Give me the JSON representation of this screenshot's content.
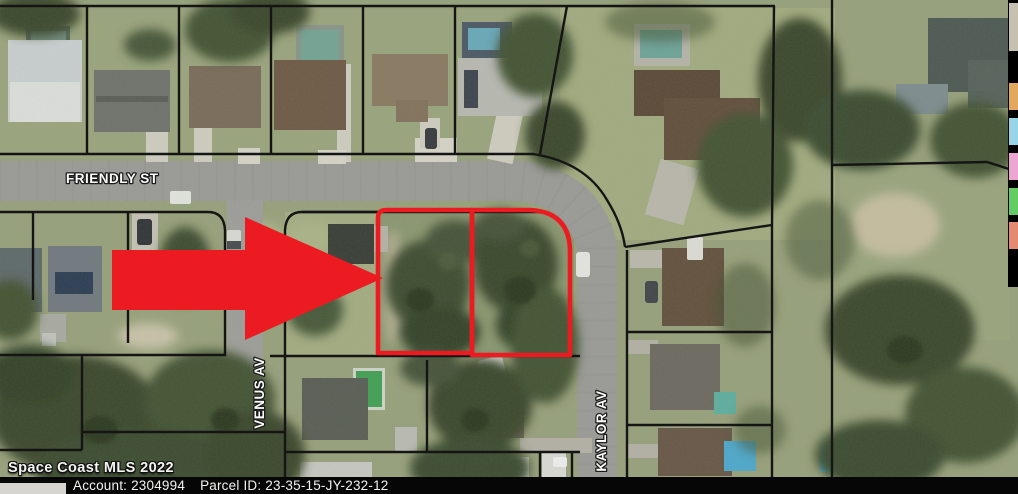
{
  "map": {
    "streets": {
      "friendly": {
        "label": "FRIENDLY ST"
      },
      "venus": {
        "label": "VENUS AV"
      },
      "kaylor": {
        "label": "KAYLOR AV"
      }
    },
    "highlight": {
      "outline_color": "#ec1b21",
      "arrow_color": "#ec1b21",
      "parcel_line_color": "#151515"
    }
  },
  "watermark": {
    "text": "Space Coast MLS 2022"
  },
  "footer": {
    "account_label": "Account:",
    "account_value": "2304994",
    "parcel_label": "Parcel ID:",
    "parcel_value": "23-35-15-JY-232-12"
  },
  "legend_strip": {
    "background": "#000000",
    "swatches": [
      {
        "name": "thumbnail-gray",
        "color": "#c6c0b0"
      },
      {
        "name": "tan",
        "color": "#e2a85c"
      },
      {
        "name": "light-blue",
        "color": "#97d4e8"
      },
      {
        "name": "pink",
        "color": "#eba6d4"
      },
      {
        "name": "green",
        "color": "#63cc63"
      },
      {
        "name": "salmon",
        "color": "#e58a70"
      }
    ]
  }
}
